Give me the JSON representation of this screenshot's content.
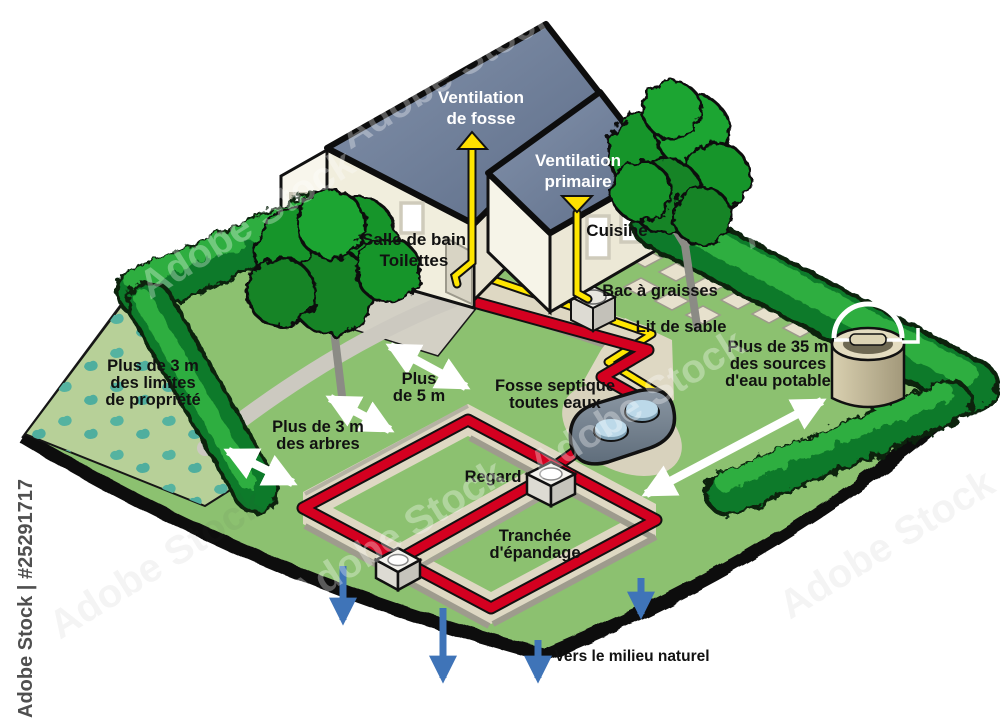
{
  "title": "Schéma d'assainissement individuel (fosse septique)",
  "watermark": {
    "side_text": "Adobe Stock | #25291717",
    "tile_text": "Adobe Stock"
  },
  "labels": {
    "ventilation_fosse": [
      "Ventilation",
      "de fosse"
    ],
    "ventilation_primaire": [
      "Ventilation",
      "primaire"
    ],
    "salle_de_bain": [
      "Salle de bain",
      "Toilettes"
    ],
    "cuisine": "Cuisine",
    "bac_a_graisses": "Bac à graisses",
    "lit_de_sable": "Lit de sable",
    "limites": [
      "Plus de 3 m",
      "des limites",
      "de propriété"
    ],
    "arbres": [
      "Plus de 3 m",
      "des arbres"
    ],
    "cinq_m": [
      "Plus",
      "de 5 m"
    ],
    "fosse_septique": [
      "Fosse septique",
      "toutes eaux"
    ],
    "regard": "Regard",
    "tranchee": [
      "Tranchée",
      "d'épandage"
    ],
    "sources": [
      "Plus de 35 m",
      "des sources",
      "d'eau potable"
    ],
    "milieu_naturel": "Vers le milieu naturel"
  },
  "colors": {
    "lawn": "#8cc170",
    "garden": "#b7d098",
    "plant_teal": "#55b3a0",
    "hedge_dark": "#117a2a",
    "hedge_light": "#2fae3f",
    "roof": "#74849e",
    "wall": "#f1eedd",
    "pipe_red": "#d40020",
    "pipe_yellow": "#ffe600",
    "tank_gray": "#77828e",
    "tank_lid_blue": "#bcd9e9",
    "trench_sand": "#ded8c3",
    "arrow_white": "#ffffff",
    "arrow_blue": "#3f74b8",
    "edge_black": "#0d0d0d"
  }
}
